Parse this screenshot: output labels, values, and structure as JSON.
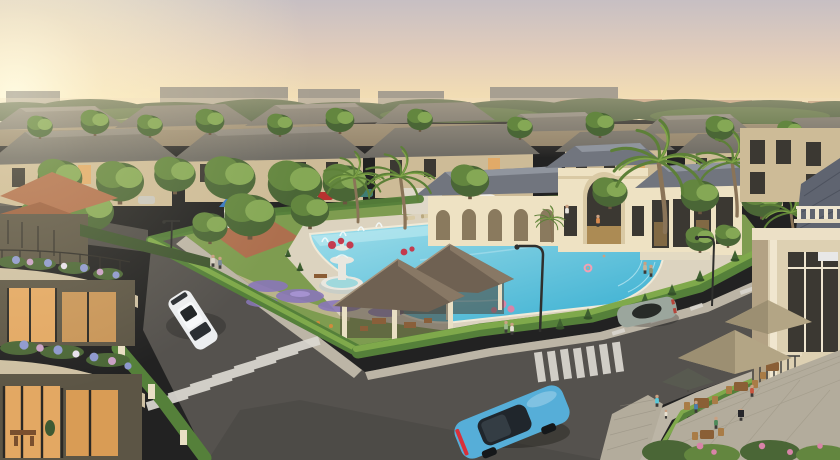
{
  "scene": {
    "type": "architectural-rendering",
    "setting": "aerial view of a luxury residential resort community at golden-hour sunset",
    "objects": [
      "warm sunset sky with sun glow at left",
      "distant city apartment blocks on horizon",
      "rows of two-and-three storey villas with gray hip roofs",
      "tall palm trees and dense green trees",
      "cream clubhouse with arched colonnade and tall arch window",
      "large turquoise swimming pool with rounded lagoon end",
      "white pool umbrellas and sun loungers",
      "two shingle-roof garden gazebos",
      "white tiered fountain with rose beds",
      "children playground with blue slide tower",
      "purple lavender flower beds",
      "manicured perimeter hedges and topiary cones",
      "asphalt streets with zebra crosswalks and dashed lane lines",
      "white suv driving on side street",
      "blue sedan at intersection",
      "silver sports car on main road",
      "street lamps",
      "cafe terrace with tan umbrellas, wooden tables and guests",
      "pedestrians and swimmers",
      "foreground villa with curved flower balconies and warm lit interiors",
      "corner apartment building with balustrade and iron balcony"
    ],
    "counts": {
      "cars_moving": 3,
      "cars_parked": 3,
      "gazebos": 2,
      "cafe_umbrellas": 3,
      "street_lamps": 3
    }
  },
  "palette": {
    "sky_top": "#c7bfc3",
    "sky_mid": "#e2cdbb",
    "sky_warm": "#f1dcb4",
    "sky_horizon": "#f5e4b8",
    "sun_glow": "#fff3cd",
    "distant_city": "#9b958b",
    "distant_red_roofs": "#aa7a60",
    "treeline_dark": "#45583a",
    "tree_dark": "#4a6636",
    "tree_mid": "#63863f",
    "tree_light": "#85a855",
    "roof_gray": "#6e6b64",
    "roof_gray_light": "#8b8780",
    "wall_tan": "#cdbb97",
    "wall_shadow": "#9c8c70",
    "window_dark": "#3b3832",
    "window_warm": "#e3a863",
    "clubhouse_wall": "#eee2c3",
    "clubhouse_roof": "#71757e",
    "pool_light": "#a9e2ec",
    "pool_deep": "#3fb2d3",
    "pool_deck": "#dcd3bf",
    "grass": "#7e9c50",
    "hedge": "#55803a",
    "hedge_light": "#7fa94b",
    "lavender": "#8a77b8",
    "flower_red": "#c43b4e",
    "flower_pink": "#d884a8",
    "playground_ground": "#b26a4e",
    "playground_blue": "#3577c2",
    "slide_orange": "#e05c2c",
    "gazebo_roof": "#6f6152",
    "gazebo_roof_light": "#8d7d69",
    "gazebo_pillar": "#e9dfc4",
    "fountain_white": "#e9e7df",
    "road": "#55524e",
    "road_dark": "#454340",
    "road_marking": "#dcd9d2",
    "sidewalk": "#bcb5a6",
    "paver": "#b3ac9c",
    "terracotta": "#b06f4c",
    "fg_wall": "#cec0a3",
    "fg_wall_dark": "#5c5545",
    "right_wall": "#ddd0b2",
    "right_wall_shadow": "#b3a284",
    "umbrella_tan": "#b3a585",
    "umbrella_white": "#f2efe6",
    "car_white": "#eceef0",
    "car_blue": "#56aed8",
    "car_silver": "#9ba69d",
    "palm_trunk": "#8a7458",
    "palm_frond": "#5d8038",
    "skin": "#c9a183",
    "hydrangea_blue": "#8d98cf",
    "hydrangea_pink": "#c9a0c6"
  }
}
